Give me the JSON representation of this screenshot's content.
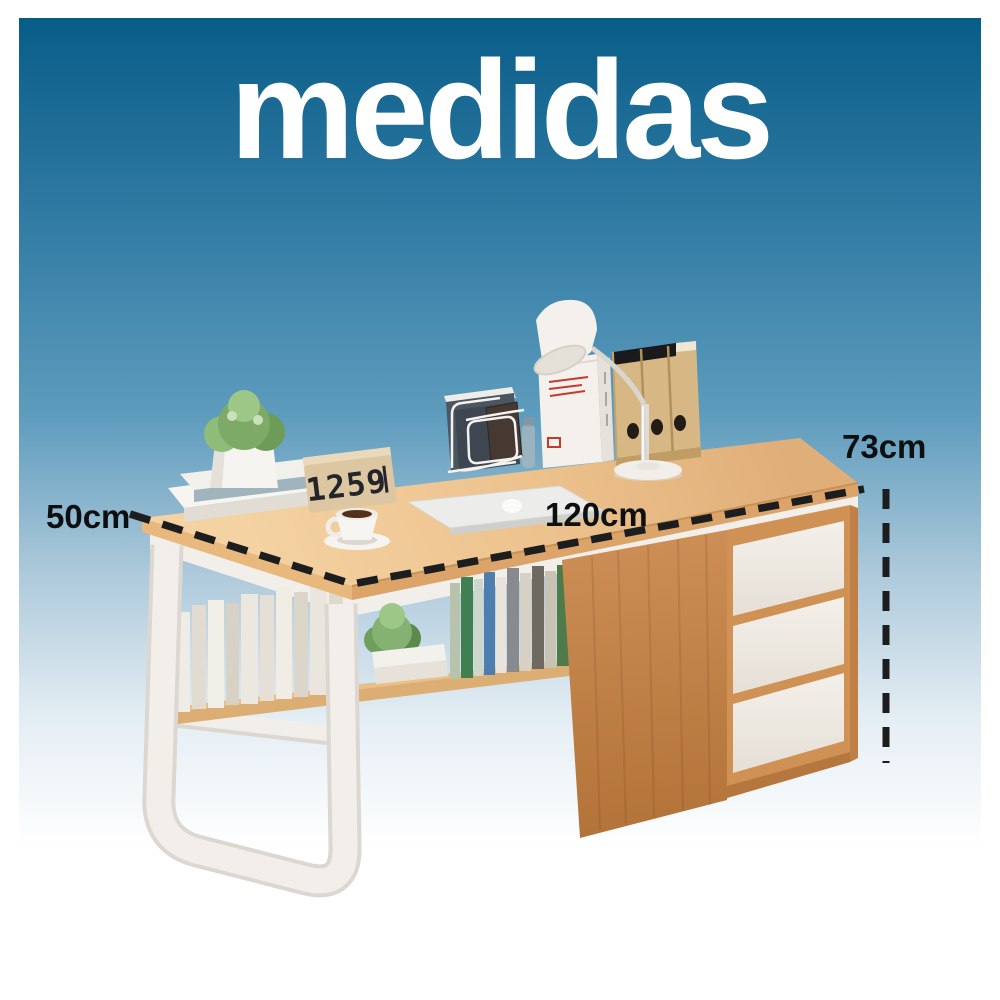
{
  "title": "medidas",
  "measurements": {
    "depth": "50cm",
    "width": "120cm",
    "height": "73cm"
  },
  "clock_display": "1259",
  "colors": {
    "page": "#ffffff",
    "bg_top": "#085d88",
    "bg_mid": "#5e9cbd",
    "bg_fade": "#aecadb",
    "title_text": "#ffffff",
    "label_text": "#0e0f11",
    "dash": "#1b1d1f",
    "wood_top": "#ecc18c",
    "wood_edge": "#dca468",
    "wood_side": "#c5854e",
    "wood_frame": "#cf9154",
    "drawer_front": "#f0ebe5",
    "shelf_wood": "#dcae74",
    "metal_white": "#f2efeb",
    "metal_shadow": "#dcd7d0"
  }
}
